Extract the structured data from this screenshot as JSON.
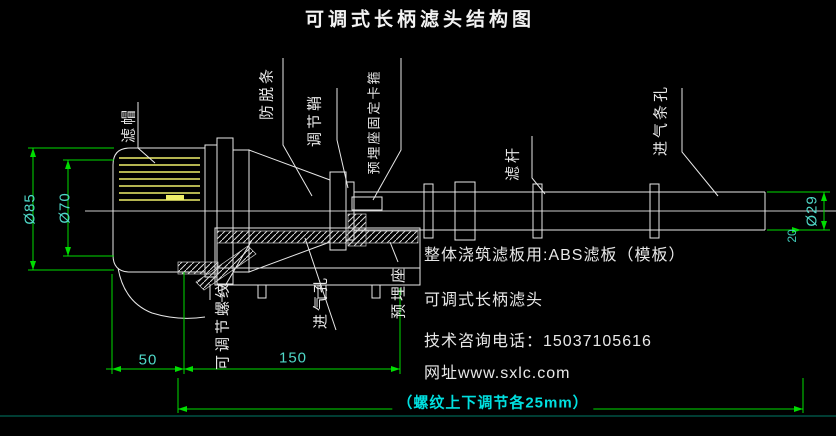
{
  "title": "可调式长柄滤头结构图",
  "part_labels": {
    "cap": "滤帽",
    "anti_slip_strip": "防脱条",
    "adjusting_sheath": "调节鞘",
    "embed_seat_clamp": "预埋座固定卡箍",
    "filter_rod": "滤杆",
    "air_inlet_slots": "进气条孔",
    "adjustable_thread": "可调节螺纹",
    "air_inlet_hole": "进气孔",
    "embedded_seat": "预埋座"
  },
  "dimensions": {
    "cap_outer_dia": "Ø85",
    "cap_inner_dia": "Ø70",
    "rod_dia": "Ø29",
    "rod_end": "20",
    "len_left": "50",
    "len_mid": "150",
    "thread_note": "（螺纹上下调节各25mm）"
  },
  "notes": {
    "abs_board": "整体浇筑滤板用:ABS滤板（模板）",
    "product_name": "可调式长柄滤头",
    "phone": "技术咨询电话：15037105616",
    "website": "网址www.sxlc.com"
  },
  "colors": {
    "background": "#000000",
    "outline_white": "#e8e8e8",
    "slot_yellow": "#f0ef6a",
    "dimension_green": "#00dd00",
    "dim_text_cyan": "#4fd8c8",
    "note_cyan": "#00e0e0"
  }
}
